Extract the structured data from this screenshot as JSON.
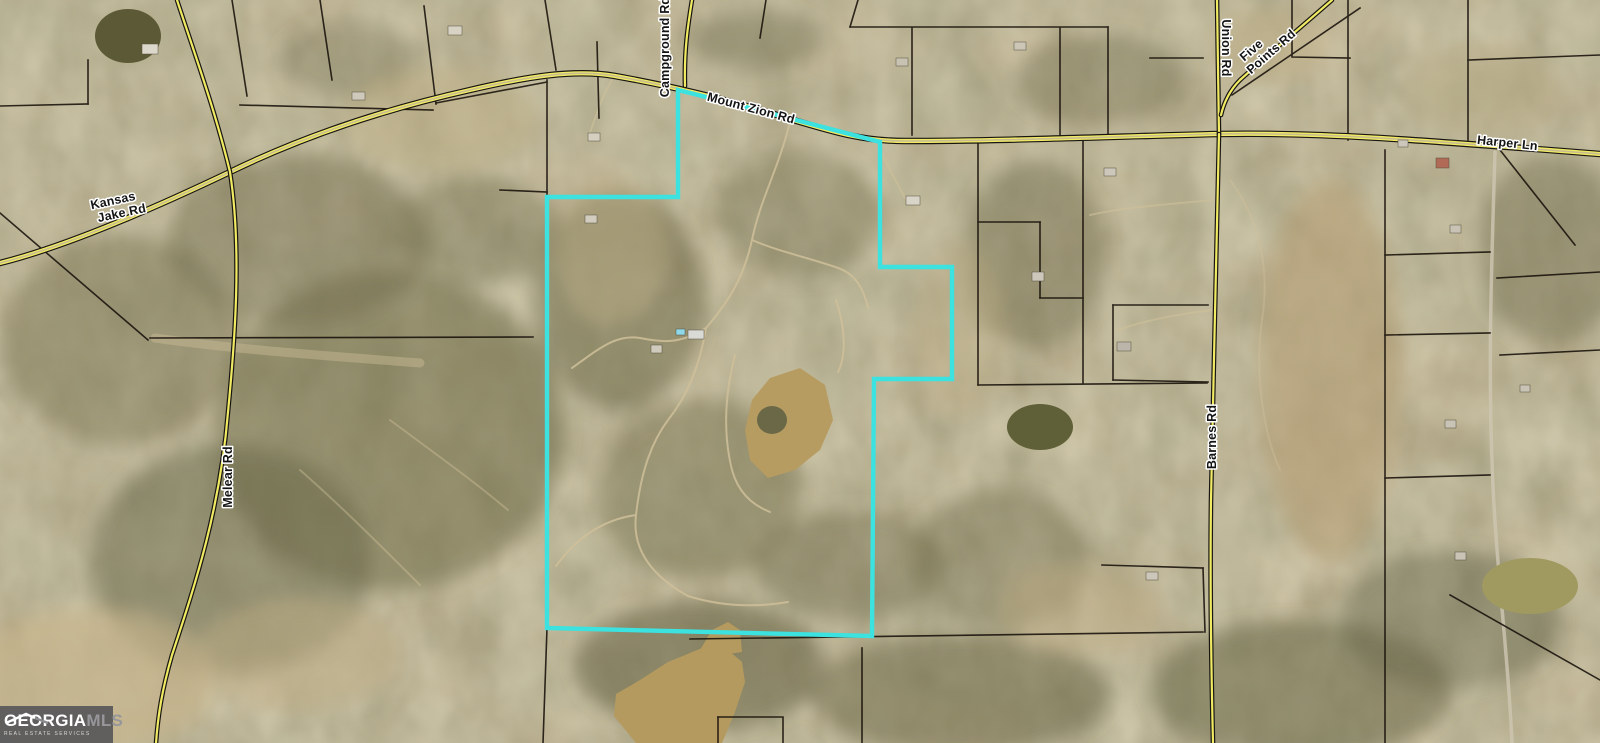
{
  "map": {
    "labels": {
      "mount_zion_rd": "Mount Zion Rd",
      "campground_rd": "Campground Rd",
      "union_rd": "Union Rd",
      "five_points_line1": "Five",
      "five_points_line2": "Points Rd",
      "harper_ln": "Harper Ln",
      "kansas_jake_line1": "Kansas",
      "kansas_jake_line2": "Jake Rd",
      "melear_rd": "Melear Rd",
      "barnes_rd": "Barnes Rd"
    },
    "colors": {
      "boundary": "#3be2e0",
      "road_fill": "#f0eb63",
      "road_center": "#c9bd90",
      "road_casing": "#181512",
      "parcel_line": "#17100a",
      "terrain_base": "#b2a07e",
      "pond_muddy": "#b79c62",
      "pond_dark": "#5f6038"
    }
  },
  "logo": {
    "brand_primary": "GEORGIA",
    "brand_secondary": "MLS",
    "tagline": "REAL ESTATE SERVICES"
  }
}
